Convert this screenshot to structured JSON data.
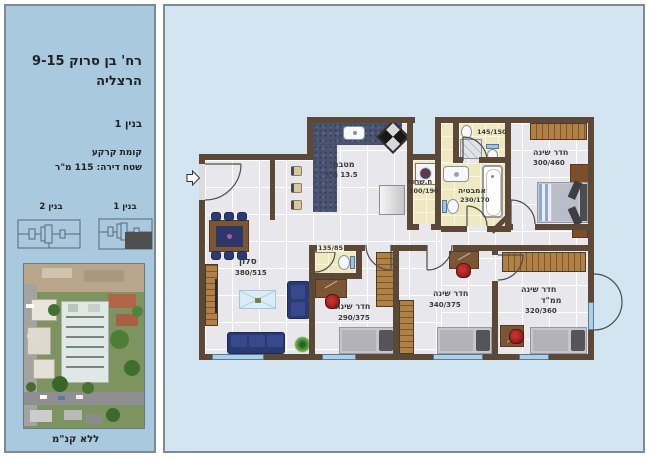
{
  "sidebar": {
    "address_line1": "רח' בן סרוק 9-15",
    "address_line2": "הרצליה",
    "building_label": "בנין 1",
    "floor_label": "קומת קרקע",
    "area_label": "שטח דירה: 115 מ\"ר",
    "mini_left_label": "בנין 2",
    "mini_right_label": "בנין 1",
    "scale_note": "ללא קנ\"מ"
  },
  "plan": {
    "kitchen": {
      "label": "מטבח",
      "dims": "13.5 מ\"ר"
    },
    "utility": {
      "label": "ח.שרות",
      "dims": "100/190"
    },
    "bathroom": {
      "label": "אמבטיה",
      "dims": "230/170"
    },
    "wc_top": {
      "dims": "145/150"
    },
    "master": {
      "label": "חדר שינה",
      "dims": "300/460"
    },
    "living": {
      "label": "סלון",
      "dims": "380/515"
    },
    "wc_small": {
      "dims": "135/85"
    },
    "bedroom2": {
      "label": "חדר שינה",
      "dims": "290/375"
    },
    "bedroom3": {
      "label": "חדר שינה",
      "dims": "340/375"
    },
    "mamad": {
      "label": "חדר שינה",
      "label2": "ממ\"ד",
      "dims": "320/360"
    }
  },
  "colors": {
    "left_panel_bg": "#a9c9de",
    "right_panel_bg": "#d2e5f1",
    "panel_border": "#7e8b95",
    "wall": "#5c4837",
    "tile_floor": "#e8e8ec",
    "wet_room_floor": "#efe9c2",
    "kitchen_counter": "#4a5470",
    "sofa_navy": "#2c3a74",
    "window_blue": "#aecfe6",
    "unit_highlight": "#4f4f4f"
  }
}
